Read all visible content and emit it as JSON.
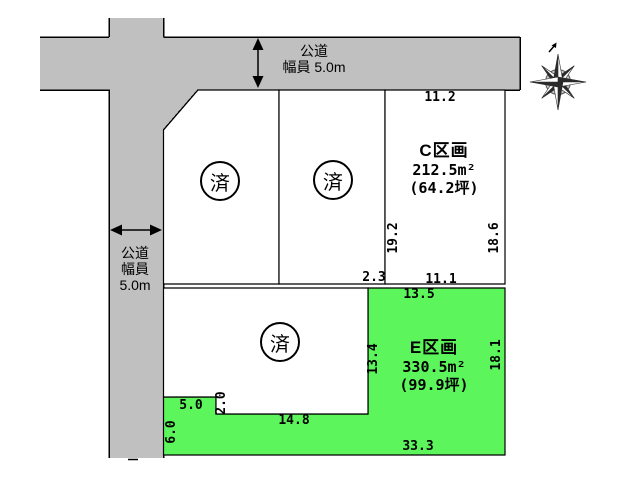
{
  "roads": {
    "top": {
      "line1": "公道",
      "line2": "幅員 5.0m"
    },
    "left": {
      "line1": "公道",
      "line2": "幅員",
      "line3": "5.0m"
    }
  },
  "plots": {
    "c": {
      "name": "C区画",
      "area_m2": "212.5m²",
      "area_tsubo": "(64.2坪)"
    },
    "e": {
      "name": "E区画",
      "area_m2": "330.5m²",
      "area_tsubo": "(99.9坪)"
    },
    "sold": {
      "a": "済",
      "b": "済",
      "d": "済"
    }
  },
  "dimensions": {
    "c_top": "11.2",
    "c_left": "19.2",
    "c_right": "18.6",
    "b_bottom": "2.3",
    "c_bottom": "11.1",
    "e_top": "13.5",
    "e_left": "13.4",
    "e_right": "18.1",
    "notch_width": "5.0",
    "notch_height": "2.0",
    "d_bottom": "14.8",
    "e_lower_left": "6.0",
    "e_bottom": "33.3"
  },
  "colors": {
    "road": "#c0c0c0",
    "available_plot": "#5cf55c",
    "line": "#000000"
  }
}
